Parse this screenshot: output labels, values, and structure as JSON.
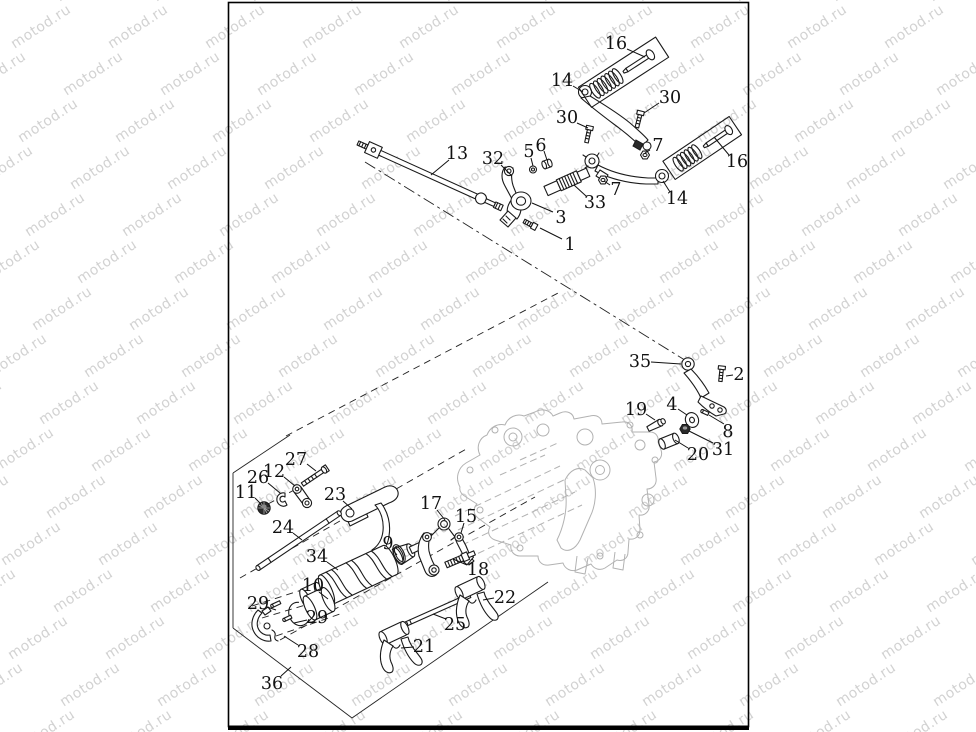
{
  "watermark": {
    "text": "motod.ru",
    "color": "#d2d2d2"
  },
  "colors": {
    "ink": "#1a1a1a",
    "ghost_case": "#b2b2b2",
    "paper": "#ffffff"
  },
  "diagram": {
    "type": "exploded-parts-diagram",
    "callouts": [
      {
        "text": "16",
        "x": 616,
        "y": 43,
        "leader": [
          627,
          49,
          645,
          57
        ]
      },
      {
        "text": "14",
        "x": 562,
        "y": 80,
        "leader": [
          573,
          86,
          583,
          92
        ]
      },
      {
        "text": "30",
        "x": 670,
        "y": 97,
        "leader": [
          659,
          103,
          644,
          113
        ]
      },
      {
        "text": "30",
        "x": 567,
        "y": 117,
        "leader": [
          577,
          123,
          588,
          128
        ]
      },
      {
        "text": "13",
        "x": 457,
        "y": 153,
        "leader": [
          449,
          160,
          431,
          175
        ]
      },
      {
        "text": "32",
        "x": 493,
        "y": 158,
        "leader": [
          501,
          165,
          512,
          176
        ]
      },
      {
        "text": "5",
        "x": 529,
        "y": 151,
        "leader": [
          531,
          158,
          533,
          166
        ]
      },
      {
        "text": "6",
        "x": 541,
        "y": 145,
        "leader": [
          544,
          151,
          547,
          160
        ]
      },
      {
        "text": "7",
        "x": 658,
        "y": 145,
        "leader": [
          650,
          150,
          645,
          153
        ]
      },
      {
        "text": "16",
        "x": 737,
        "y": 161,
        "leader": [
          729,
          155,
          714,
          137
        ]
      },
      {
        "text": "7",
        "x": 616,
        "y": 189,
        "leader": [
          610,
          185,
          604,
          181
        ]
      },
      {
        "text": "33",
        "x": 595,
        "y": 202,
        "leader": [
          586,
          196,
          574,
          185
        ]
      },
      {
        "text": "3",
        "x": 561,
        "y": 217,
        "leader": [
          553,
          212,
          532,
          203
        ]
      },
      {
        "text": "14",
        "x": 677,
        "y": 198,
        "leader": [
          670,
          192,
          663,
          181
        ]
      },
      {
        "text": "1",
        "x": 570,
        "y": 244,
        "leader": [
          562,
          239,
          540,
          228
        ]
      },
      {
        "text": "35",
        "x": 640,
        "y": 361,
        "leader": [
          651,
          362,
          681,
          364
        ]
      },
      {
        "text": "2",
        "x": 739,
        "y": 374,
        "leader": [
          733,
          375,
          726,
          376
        ]
      },
      {
        "text": "19",
        "x": 636,
        "y": 409,
        "leader": [
          646,
          414,
          655,
          420
        ]
      },
      {
        "text": "4",
        "x": 672,
        "y": 404,
        "leader": [
          678,
          409,
          687,
          415
        ]
      },
      {
        "text": "8",
        "x": 728,
        "y": 431,
        "leader": [
          724,
          424,
          709,
          415
        ]
      },
      {
        "text": "20",
        "x": 698,
        "y": 454,
        "leader": [
          688,
          448,
          675,
          440
        ]
      },
      {
        "text": "31",
        "x": 723,
        "y": 449,
        "leader": [
          713,
          443,
          689,
          431
        ]
      },
      {
        "text": "27",
        "x": 296,
        "y": 459,
        "leader": [
          307,
          464,
          316,
          471
        ]
      },
      {
        "text": "26",
        "x": 258,
        "y": 477,
        "leader": [
          268,
          483,
          280,
          493
        ]
      },
      {
        "text": "12",
        "x": 274,
        "y": 471,
        "leader": [
          284,
          477,
          295,
          486
        ]
      },
      {
        "text": "11",
        "x": 246,
        "y": 492,
        "leader": [
          255,
          498,
          261,
          504
        ]
      },
      {
        "text": "23",
        "x": 335,
        "y": 494,
        "leader": [
          343,
          501,
          352,
          509
        ]
      },
      {
        "text": "24",
        "x": 283,
        "y": 527,
        "leader": [
          293,
          533,
          302,
          540
        ]
      },
      {
        "text": "34",
        "x": 317,
        "y": 556,
        "leader": [
          327,
          562,
          338,
          570
        ]
      },
      {
        "text": "9",
        "x": 388,
        "y": 543,
        "leader": [
          392,
          549,
          397,
          555
        ]
      },
      {
        "text": "10",
        "x": 313,
        "y": 585,
        "leader": [
          319,
          592,
          328,
          599
        ]
      },
      {
        "text": "17",
        "x": 431,
        "y": 503,
        "leader": [
          437,
          510,
          445,
          520
        ]
      },
      {
        "text": "15",
        "x": 466,
        "y": 516,
        "leader": [
          464,
          523,
          461,
          533
        ]
      },
      {
        "text": "18",
        "x": 478,
        "y": 569,
        "leader": [
          467,
          565,
          453,
          559
        ]
      },
      {
        "text": "22",
        "x": 505,
        "y": 597,
        "leader": [
          494,
          598,
          483,
          600
        ]
      },
      {
        "text": "25",
        "x": 455,
        "y": 624,
        "leader": [
          446,
          619,
          433,
          614
        ]
      },
      {
        "text": "21",
        "x": 424,
        "y": 646,
        "leader": [
          414,
          647,
          401,
          648
        ]
      },
      {
        "text": "29",
        "x": 258,
        "y": 603,
        "leader": [
          267,
          607,
          276,
          610
        ]
      },
      {
        "text": "29",
        "x": 317,
        "y": 617,
        "leader": [
          307,
          620,
          294,
          623
        ]
      },
      {
        "text": "28",
        "x": 308,
        "y": 651,
        "leader": [
          298,
          645,
          284,
          636
        ]
      },
      {
        "text": "36",
        "x": 272,
        "y": 683,
        "leader": [
          281,
          676,
          291,
          667
        ]
      }
    ]
  }
}
